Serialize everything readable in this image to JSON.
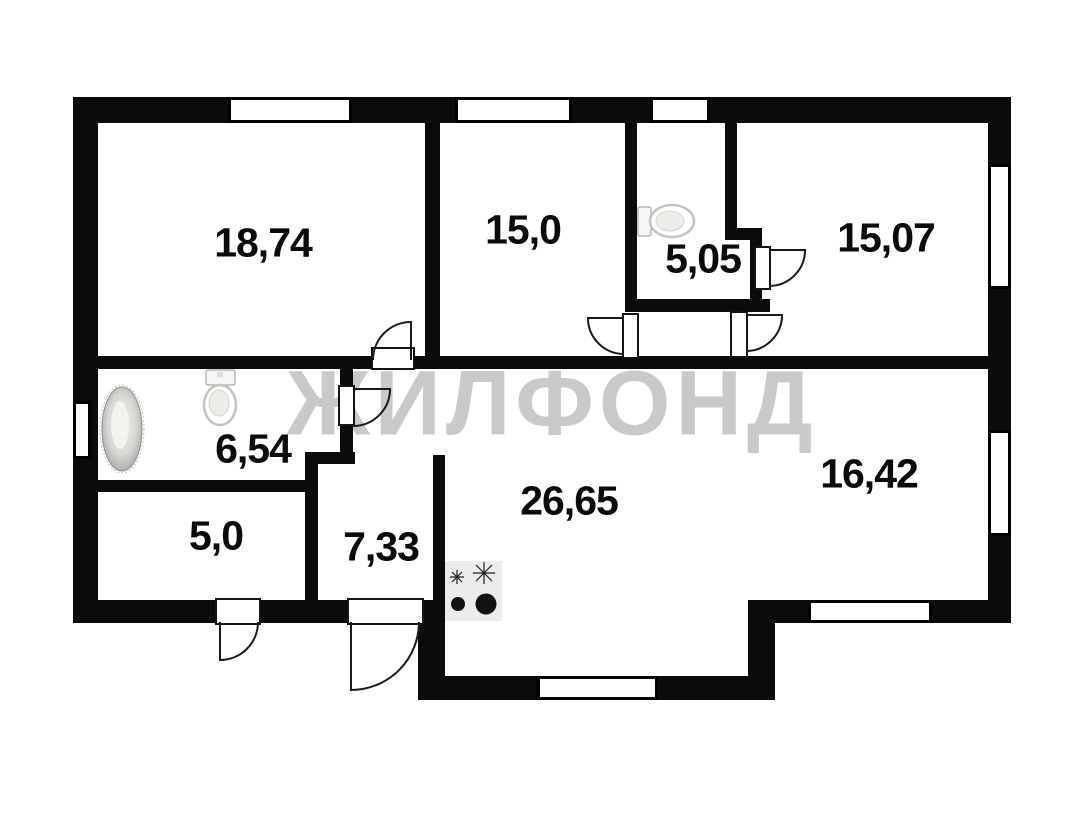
{
  "floorplan": {
    "watermark_text": "ЖИЛФОНД",
    "rooms": [
      {
        "name": "room-top-left",
        "area_label": "18,74"
      },
      {
        "name": "room-top-middle",
        "area_label": "15,0"
      },
      {
        "name": "room-wc",
        "area_label": "5,05"
      },
      {
        "name": "room-top-right",
        "area_label": "15,07"
      },
      {
        "name": "room-bathroom",
        "area_label": "6,54"
      },
      {
        "name": "room-storage",
        "area_label": "5,0"
      },
      {
        "name": "room-entry-hall",
        "area_label": "7,33"
      },
      {
        "name": "room-kitchen-living",
        "area_label": "26,65"
      },
      {
        "name": "room-right-open",
        "area_label": "16,42"
      }
    ],
    "fixtures": [
      {
        "name": "bathtub"
      },
      {
        "name": "toilet-bathroom"
      },
      {
        "name": "toilet-wc"
      },
      {
        "name": "stove-two-burners"
      }
    ],
    "colors": {
      "wall": "#0b0b0b",
      "watermark": "#c7c9cb",
      "label": "#0a0a0a",
      "stove_fill": "#ececec"
    }
  }
}
